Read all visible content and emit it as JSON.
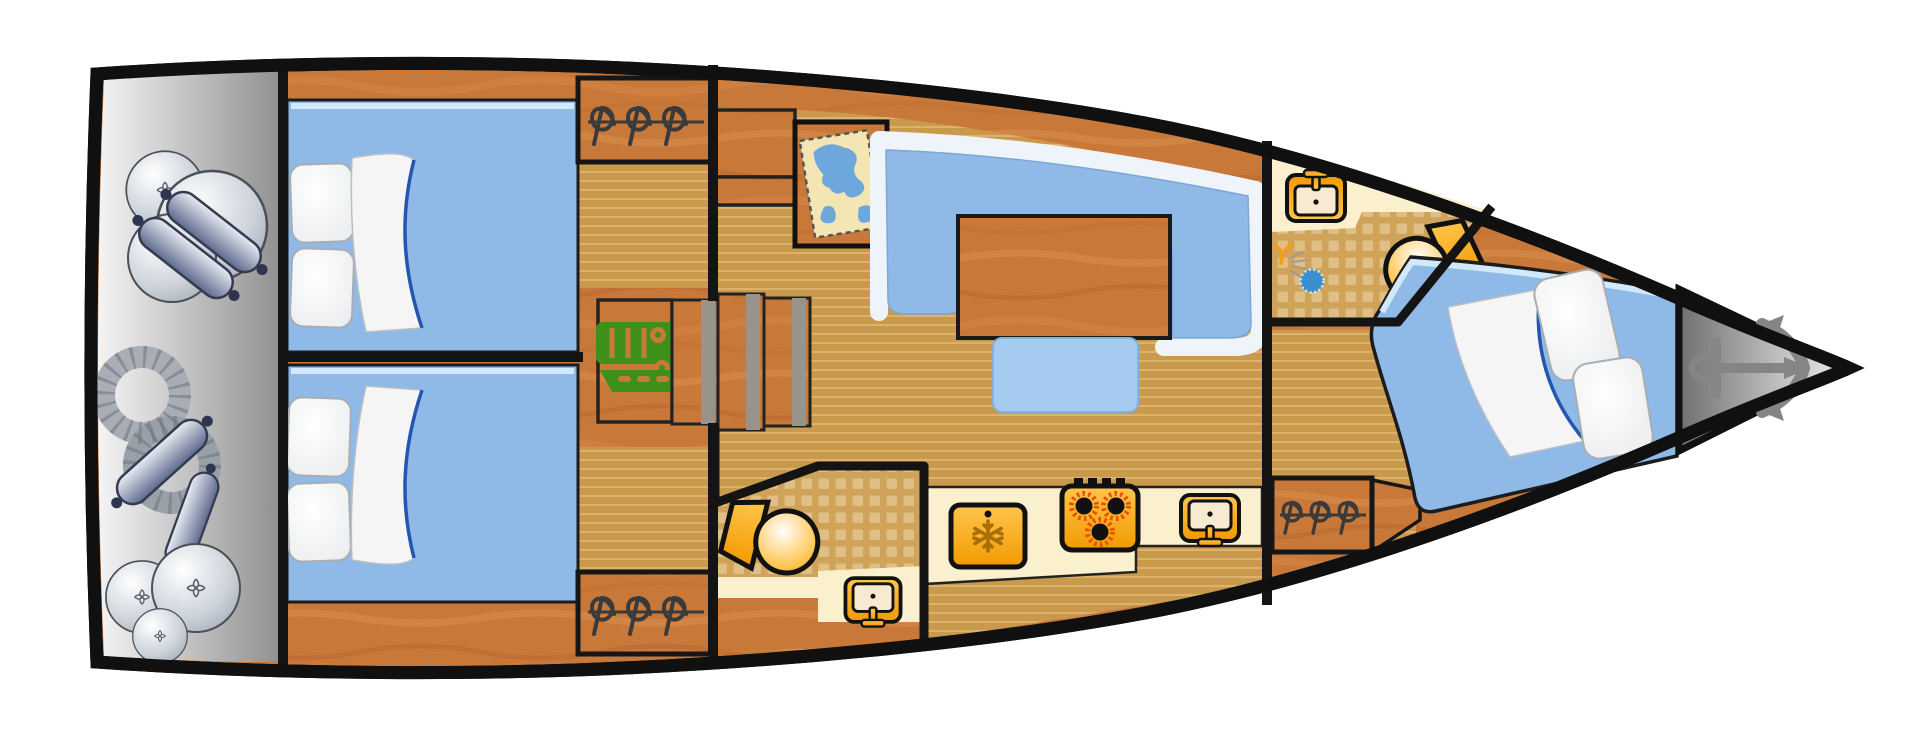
{
  "scene": {
    "type": "sailing-yacht-interior-floor-plan",
    "view": "top-down",
    "orientation": "bow-right"
  },
  "colors": {
    "hull_outline": "#101010",
    "wall": "#141414",
    "wood": "#c8793a",
    "floor_base": "#c99a4c",
    "floor_stripe": "#ddb26e",
    "tile_base": "#cfa359",
    "tile_square": "#e2c48d",
    "bed_blue": "#8fbae7",
    "bed_highlight": "#d2e8fb",
    "stool_blue": "#a6cbf0",
    "backrest_white": "#eef4fa",
    "counter_cream": "#fbf0cd",
    "appliance_orange": "#f5a01e",
    "burner_flame": "#e85000",
    "engine_green": "#3e8f1c",
    "anchor_gray": "#858585",
    "hanger_dark": "#3a3a3a",
    "fender_steel": "#6a7794",
    "map_paper": "#f3e6b4",
    "map_water": "#6ea7dc",
    "shower_blue": "#3a8fd0",
    "sheet_white": "#f5f5f5",
    "sheet_fold_blue": "#2456b0",
    "step_gray": "#98938b",
    "snowflake_brown": "#a66f08"
  },
  "areas": {
    "stern_deck": {
      "items": [
        "round-fender",
        "round-fender",
        "round-fender",
        "sausage-fender",
        "sausage-fender",
        "rope-coil",
        "sausage-fender",
        "sausage-fender",
        "round-fender",
        "round-fender",
        "round-fender"
      ]
    },
    "aft_cabin_port": {
      "furniture": [
        "double-bed",
        "pillow",
        "pillow",
        "folded-blanket",
        "hanging-locker"
      ]
    },
    "aft_cabin_starboard": {
      "furniture": [
        "double-bed",
        "pillow",
        "pillow",
        "folded-blanket",
        "hanging-locker"
      ]
    },
    "engine_compartment": {
      "items": [
        "engine"
      ]
    },
    "companionway": {
      "items": [
        "upper-steps",
        "lower-steps-3-planks"
      ]
    },
    "salon": {
      "furniture": [
        "chart-table-with-map",
        "u-shaped-settee",
        "dining-table",
        "bench-seat"
      ]
    },
    "aft_head": {
      "fixtures": [
        "toilet",
        "washbasin"
      ]
    },
    "galley": {
      "appliances": [
        "refrigerator",
        "stove-3-burners",
        "sink"
      ]
    },
    "forward_head": {
      "fixtures": [
        "washbasin",
        "shower-drain",
        "toilet"
      ]
    },
    "forward_cabin": {
      "furniture": [
        "double-v-berth",
        "pillow",
        "pillow",
        "folded-blanket",
        "hanging-locker"
      ]
    },
    "bow_locker": {
      "items": [
        "anchor"
      ]
    }
  }
}
